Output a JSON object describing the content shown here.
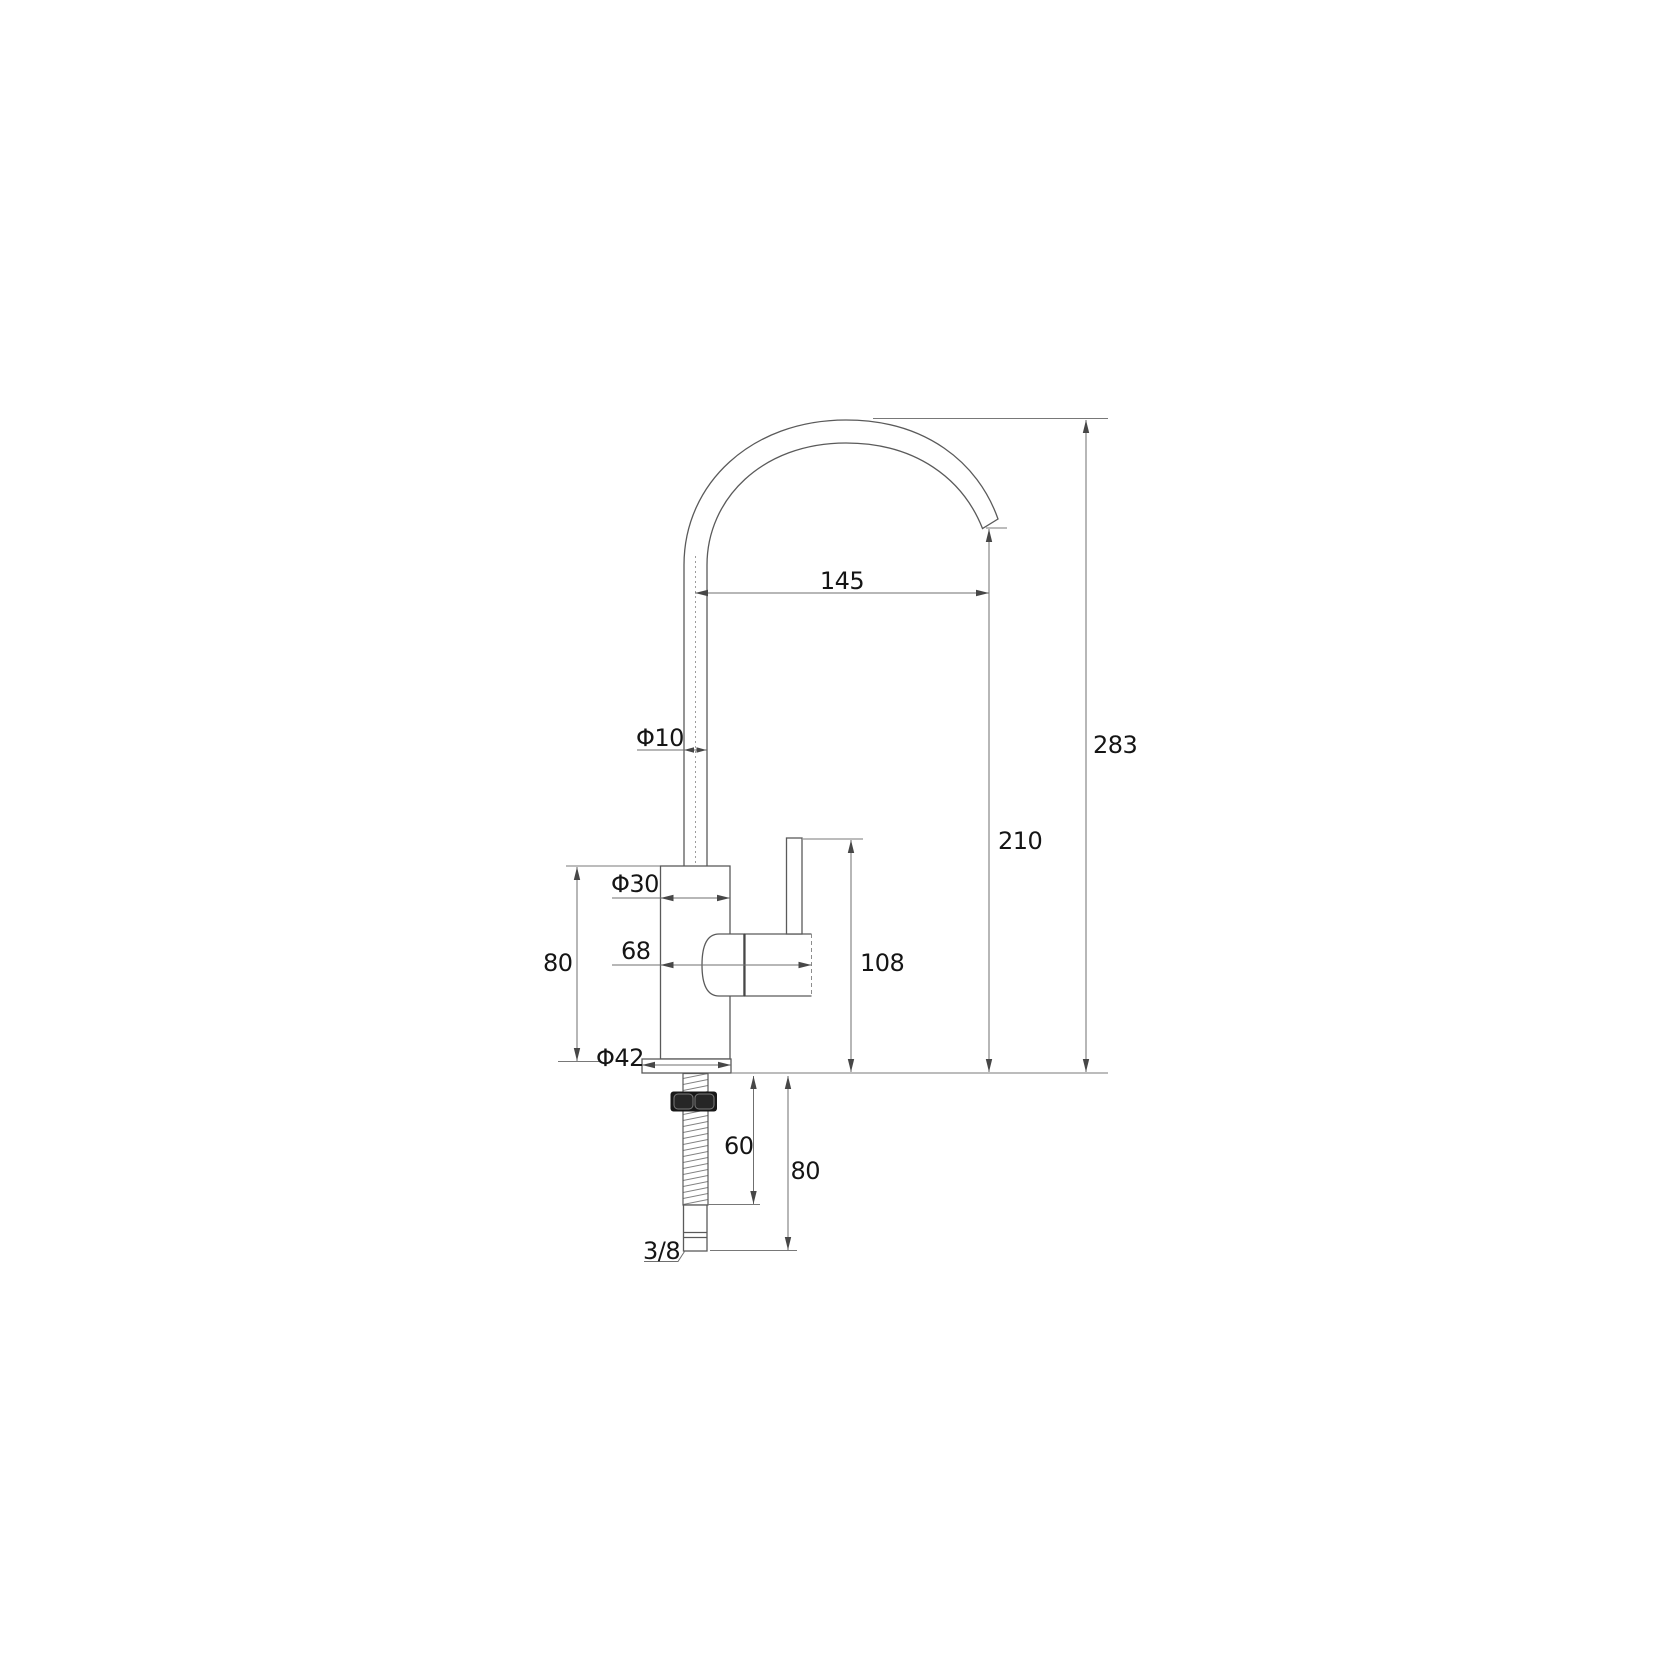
{
  "labels": {
    "spout_reach": "145",
    "overall_height": "283",
    "outlet_height": "210",
    "spout_tube_diameter": "Φ10",
    "body_diameter": "Φ30",
    "body_height": "80",
    "body_span": "68",
    "handle_top_height": "108",
    "base_flange_diameter": "Φ42",
    "shank_thread_length": "60",
    "shank_total_length": "80",
    "inlet_connection": "3/8"
  },
  "colors": {
    "background": "#ffffff",
    "object_line": "#5a5a5a",
    "dimension_line": "#6f6f6f",
    "text": "#151515",
    "nut_fill": "#181818"
  }
}
